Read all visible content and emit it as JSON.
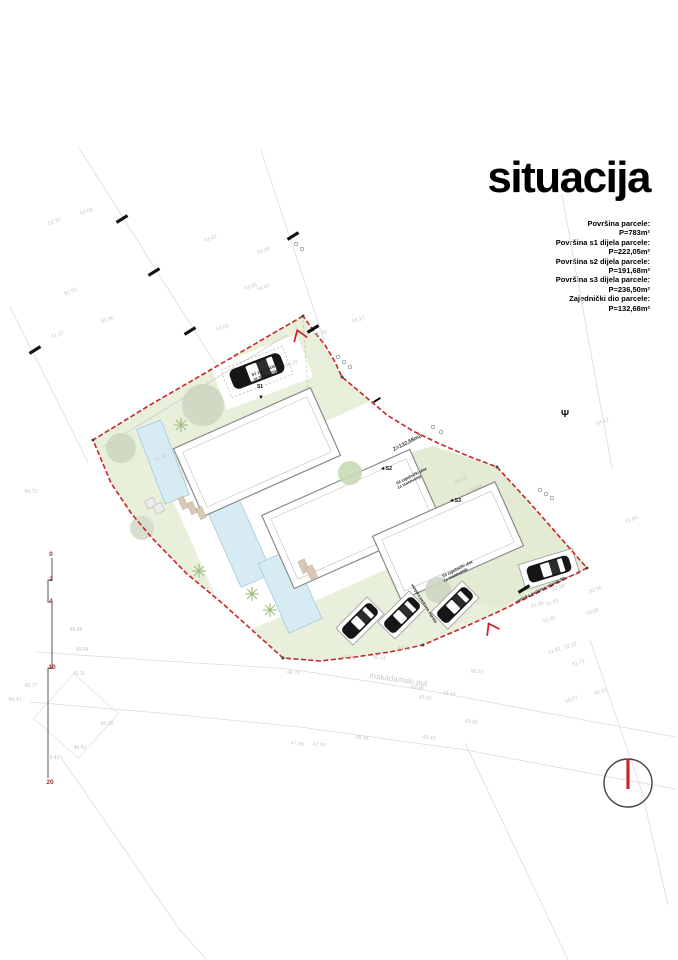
{
  "title": "situacija",
  "info": {
    "lines": [
      "Površina parcele:",
      "P=783m²",
      "Površina s1 dijela parcele:",
      "P=222,05m²",
      "Površina s2 dijela parcele:",
      "P=191,68m²",
      "Površina s3 dijela parcele:",
      "P=236,50m²",
      "Zajednički dio parcele:",
      "P=132,68m²"
    ]
  },
  "colors": {
    "boundary_red": "#c9252b",
    "site_green": "#e8efdb",
    "pool_blue": "#d7ebf4",
    "compass_needle": "#c9252b",
    "scale_label_red": "#a03232",
    "spot_gray": "#c6c6c6"
  },
  "plan": {
    "scale_bar": {
      "labels": [
        {
          "t": "0",
          "x": 51,
          "y": 556
        },
        {
          "t": "2",
          "x": 51,
          "y": 581
        },
        {
          "t": "4",
          "x": 51,
          "y": 603
        },
        {
          "t": "10",
          "x": 52,
          "y": 669
        },
        {
          "t": "20",
          "x": 50,
          "y": 784
        }
      ]
    },
    "labels": [
      {
        "t": "Z=132,68m2",
        "x": 408,
        "y": 444,
        "r": -27,
        "s": 5.5,
        "c": "#3a3a3a",
        "b": true
      },
      {
        "t": "◄S2",
        "x": 386,
        "y": 470,
        "r": 0,
        "s": 5.5,
        "c": "#111",
        "b": true
      },
      {
        "t": "◄S3",
        "x": 455,
        "y": 502,
        "r": 0,
        "s": 5.5,
        "c": "#111",
        "b": true
      },
      {
        "t": "S1 zajednički ulaz",
        "x": 268,
        "y": 370,
        "r": -21,
        "s": 4,
        "c": "#222",
        "b": true
      },
      {
        "t": "za stanovanje",
        "x": 266,
        "y": 376,
        "r": -21,
        "s": 4,
        "c": "#222",
        "b": true
      },
      {
        "t": "S1",
        "x": 260,
        "y": 388,
        "r": 0,
        "s": 5,
        "c": "#111",
        "b": true
      },
      {
        "t": "▼",
        "x": 261,
        "y": 399,
        "r": 0,
        "s": 6,
        "c": "#111",
        "b": false
      },
      {
        "t": "S2 zajednički ulaz",
        "x": 412,
        "y": 477,
        "r": -27,
        "s": 4,
        "c": "#222",
        "b": true
      },
      {
        "t": "za stanovanje",
        "x": 410,
        "y": 483,
        "r": -27,
        "s": 4,
        "c": "#222",
        "b": true
      },
      {
        "t": "S3 zajednički ulaz",
        "x": 458,
        "y": 570,
        "r": -27,
        "s": 4,
        "c": "#222",
        "b": true
      },
      {
        "t": "za stanovanje",
        "x": 456,
        "y": 576,
        "r": -27,
        "s": 4,
        "c": "#222",
        "b": true
      },
      {
        "t": "vanjska parkirna mjesta",
        "x": 423,
        "y": 604,
        "r": 58,
        "s": 4,
        "c": "#222",
        "b": true
      },
      {
        "t": "vanjsko parkirno mjesto S2",
        "x": 541,
        "y": 591,
        "r": -26,
        "s": 4.2,
        "c": "#222",
        "b": true
      },
      {
        "t": "makadamski put",
        "x": 398,
        "y": 682,
        "r": 8,
        "s": 8,
        "c": "#c9c9c9",
        "b": false
      },
      {
        "t": "Ψ",
        "x": 565,
        "y": 417,
        "r": 0,
        "s": 10,
        "c": "#111",
        "b": true
      }
    ],
    "spots": [
      {
        "t": "52.09",
        "x": 87,
        "y": 213,
        "r": -20
      },
      {
        "t": "52.20",
        "x": 55,
        "y": 223,
        "r": -20
      },
      {
        "t": "53.42",
        "x": 211,
        "y": 240,
        "r": -20
      },
      {
        "t": "54.34",
        "x": 264,
        "y": 252,
        "r": -20
      },
      {
        "t": "53.65",
        "x": 251,
        "y": 288,
        "r": -20
      },
      {
        "t": "54.45",
        "x": 264,
        "y": 289,
        "r": -20
      },
      {
        "t": "51.55",
        "x": 71,
        "y": 293,
        "r": -20
      },
      {
        "t": "52.96",
        "x": 108,
        "y": 321,
        "r": -20
      },
      {
        "t": "53.03",
        "x": 223,
        "y": 329,
        "r": -20
      },
      {
        "t": "51.22",
        "x": 58,
        "y": 336,
        "r": -20
      },
      {
        "t": "55.17",
        "x": 359,
        "y": 321,
        "r": -20
      },
      {
        "t": "55.08",
        "x": 321,
        "y": 335,
        "r": -20
      },
      {
        "t": "54.23",
        "x": 292,
        "y": 365,
        "r": -20
      },
      {
        "t": "54.02",
        "x": 462,
        "y": 481,
        "r": -24
      },
      {
        "t": "53.94",
        "x": 477,
        "y": 489,
        "r": -24
      },
      {
        "t": "54.12",
        "x": 603,
        "y": 423,
        "r": -20
      },
      {
        "t": "53.89",
        "x": 632,
        "y": 521,
        "r": -20
      },
      {
        "t": "51.34",
        "x": 161,
        "y": 459,
        "r": -20
      },
      {
        "t": "52.50",
        "x": 559,
        "y": 589,
        "r": -18
      },
      {
        "t": "52.90",
        "x": 596,
        "y": 591,
        "r": -18
      },
      {
        "t": "51.95",
        "x": 538,
        "y": 606,
        "r": -18
      },
      {
        "t": "51.93",
        "x": 553,
        "y": 604,
        "r": -18
      },
      {
        "t": "53.58",
        "x": 593,
        "y": 613,
        "r": -18
      },
      {
        "t": "51.85",
        "x": 550,
        "y": 621,
        "r": -18
      },
      {
        "t": "52.12",
        "x": 571,
        "y": 647,
        "r": -18
      },
      {
        "t": "51.82",
        "x": 555,
        "y": 652,
        "r": -18
      },
      {
        "t": "51.71",
        "x": 579,
        "y": 664,
        "r": -18
      },
      {
        "t": "50.61",
        "x": 601,
        "y": 693,
        "r": -18
      },
      {
        "t": "50.07",
        "x": 572,
        "y": 701,
        "r": -18
      },
      {
        "t": "48.75",
        "x": 293,
        "y": 674,
        "r": 6
      },
      {
        "t": "49.26",
        "x": 348,
        "y": 659,
        "r": 6
      },
      {
        "t": "50.14",
        "x": 379,
        "y": 659,
        "r": 6
      },
      {
        "t": "49.74",
        "x": 404,
        "y": 650,
        "r": 6
      },
      {
        "t": "49.46",
        "x": 417,
        "y": 689,
        "r": 6
      },
      {
        "t": "49.81",
        "x": 425,
        "y": 699,
        "r": 6
      },
      {
        "t": "49.44",
        "x": 449,
        "y": 695,
        "r": 6
      },
      {
        "t": "50.43",
        "x": 477,
        "y": 673,
        "r": 6
      },
      {
        "t": "48.40",
        "x": 429,
        "y": 739,
        "r": 6
      },
      {
        "t": "49.58",
        "x": 471,
        "y": 723,
        "r": 6
      },
      {
        "t": "48.46",
        "x": 362,
        "y": 739,
        "r": 6
      },
      {
        "t": "47.56",
        "x": 297,
        "y": 745,
        "r": 6
      },
      {
        "t": "47.99",
        "x": 319,
        "y": 746,
        "r": 6
      },
      {
        "t": "49.71",
        "x": 31,
        "y": 493,
        "r": 0
      },
      {
        "t": "48.85",
        "x": 76,
        "y": 631,
        "r": 0
      },
      {
        "t": "48.08",
        "x": 82,
        "y": 651,
        "r": 0
      },
      {
        "t": "46.11",
        "x": 79,
        "y": 675,
        "r": 0
      },
      {
        "t": "45.77",
        "x": 31,
        "y": 687,
        "r": 0
      },
      {
        "t": "45.41",
        "x": 15,
        "y": 701,
        "r": 0
      },
      {
        "t": "46.28",
        "x": 107,
        "y": 725,
        "r": 0
      },
      {
        "t": "45.42",
        "x": 80,
        "y": 749,
        "r": 0
      },
      {
        "t": "45.42",
        "x": 53,
        "y": 759,
        "r": 0
      }
    ]
  }
}
